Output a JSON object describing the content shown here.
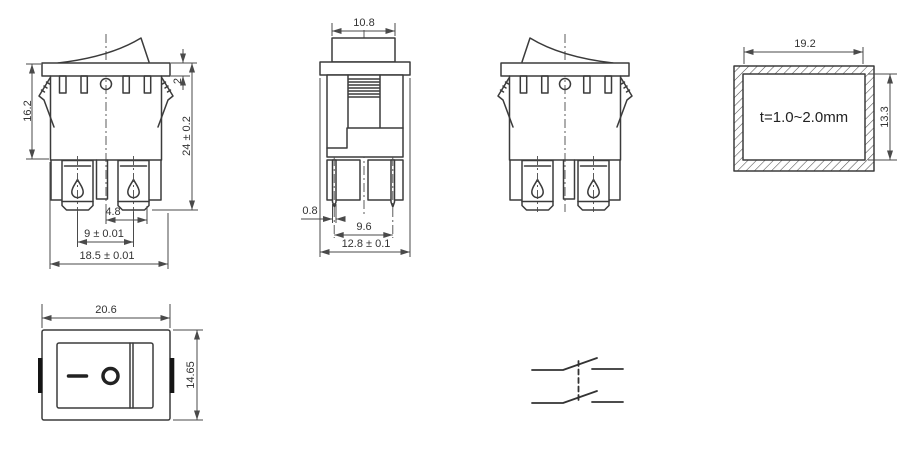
{
  "front_view": {
    "height_upper": "16.2",
    "bezel_thickness": "2",
    "height_total": "24 ± 0.2",
    "terminal_offset": "4.8",
    "terminal_pitch": "9 ± 0.01",
    "body_width": "18.5 ± 0.01"
  },
  "side_view": {
    "rocker_width": "10.8",
    "pin_thickness": "0.8",
    "pin_pitch": "9.6",
    "body_depth": "12.8 ± 0.1"
  },
  "panel_cutout": {
    "width": "19.2",
    "height": "13.3",
    "thickness_note": "t=1.0~2.0mm"
  },
  "face_view": {
    "width": "20.6",
    "height": "14.65",
    "on_symbol": "—",
    "off_symbol": "O"
  }
}
